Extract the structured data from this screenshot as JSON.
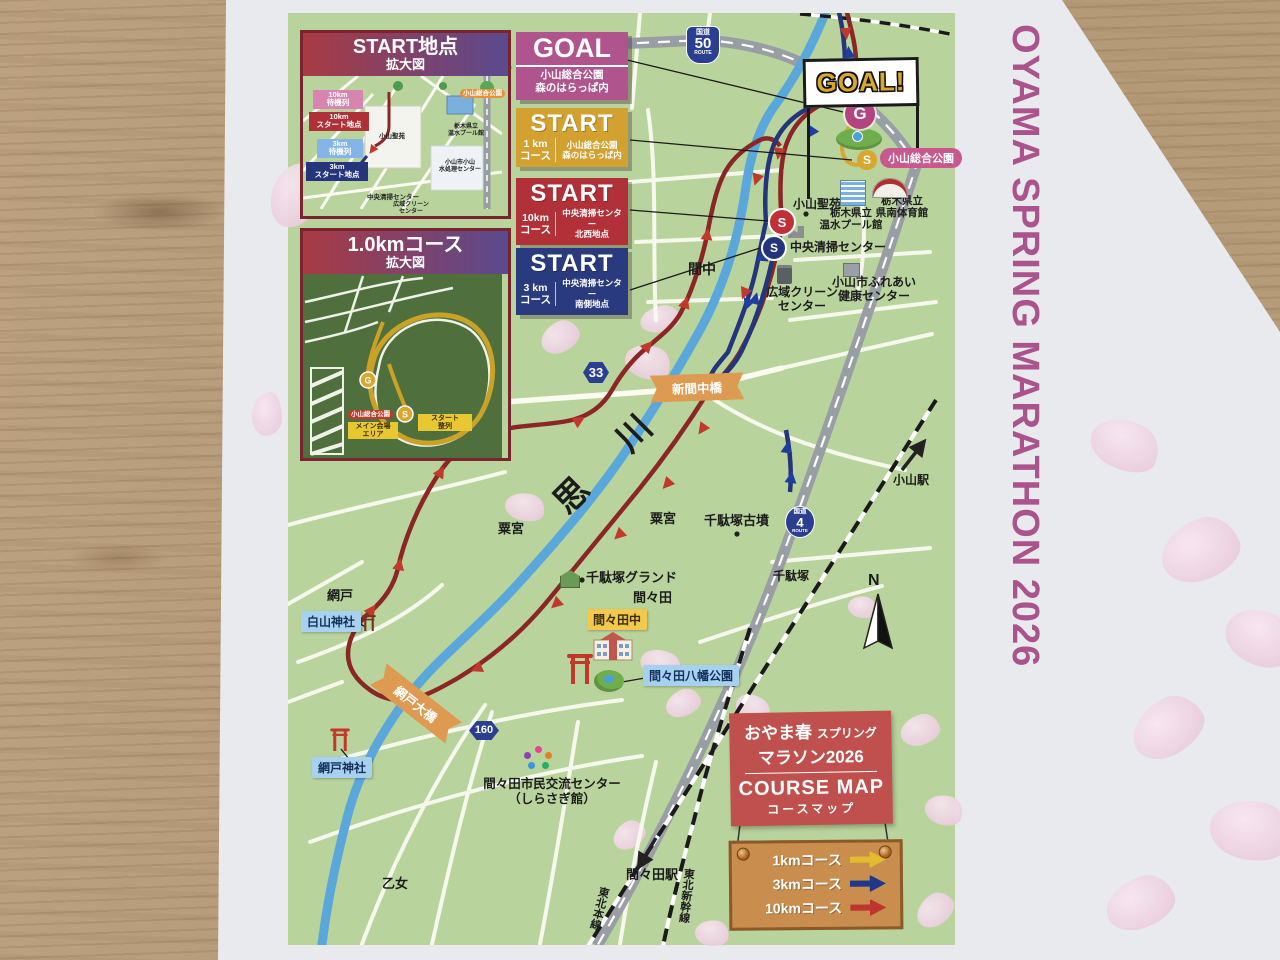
{
  "side_title": "OYAMA SPRING MARATHON 2026",
  "goal_banner": "GOAL!",
  "markers": {
    "g": "G",
    "s": "S",
    "n": "N"
  },
  "goal_box": {
    "title": "GOAL",
    "location": "小山総合公園\n森のはらっぱ内"
  },
  "start_boxes": [
    {
      "title": "START",
      "course": "1 km\nコース",
      "location": "小山総合公園\n森のはらっぱ内"
    },
    {
      "title": "START",
      "course": "10km\nコース",
      "location": "中央清掃センター\n北西地点"
    },
    {
      "title": "START",
      "course": "3 km\nコース",
      "location": "中央清掃センター\n南側地点"
    }
  ],
  "inset_start": {
    "title": "START地点",
    "subtitle": "拡大図",
    "tags": {
      "wait10": "10km\n待機列",
      "start10": "10km\nスタート地点",
      "wait3": "3km\n待機列",
      "start3": "3km\nスタート地点"
    },
    "places": {
      "seien": "小山聖苑",
      "pool": "栃木県立\n温水プール館",
      "mizushori": "小山市小山\n水処理センター",
      "seiso": "中央清掃センター",
      "clean": "広域クリーン\nセンター",
      "park": "小山総合公園"
    }
  },
  "inset_1km": {
    "title": "1.0kmコース",
    "subtitle": "拡大図",
    "park": "小山総合公園",
    "main_area": "メイン会場\nエリア",
    "start_grid": "スタート\n整列"
  },
  "badges": {
    "r50": {
      "kanji": "国道",
      "num": "50",
      "route": "ROUTE"
    },
    "r4": {
      "kanji": "国道",
      "num": "4",
      "route": "ROUTE"
    },
    "r33": "33",
    "r160": "160"
  },
  "map_labels": {
    "mamanaka": "間中",
    "omoigawa": "思　川",
    "awanomiya_w": "粟宮",
    "awanomiya_e": "粟宮",
    "sendazuka_kofun": "千駄塚古墳",
    "sendazuka": "千駄塚",
    "sendazuka_ground": "千駄塚グランド",
    "mamada": "間々田",
    "mamada_chu": "間々田中",
    "mamada_hachiman": "間々田八幡公園",
    "ajito": "網戸",
    "hakusan_jinja": "白山神社",
    "ajito_ohashi": "網戸大橋",
    "ajito_jinja": "網戸神社",
    "shimin_center": "間々田市民交流センター\n（しらさぎ館）",
    "otome": "乙女",
    "mamada_sta": "間々田駅",
    "tohoku_honsen": "東北本線",
    "tohoku_shinkansen": "東北新幹線",
    "oyama_sta": "小山駅",
    "shinmamanaka_bashi": "新間中橋",
    "oyama_seien": "小山聖苑",
    "onsui_pool": "栃木県立\n温水プール館",
    "kennan_gym": "栃木県立\n県南体育館",
    "chuo_seiso": "中央清掃センター",
    "koiki_clean": "広域クリーン\nセンター",
    "fureai": "小山市ふれあい\n健康センター",
    "sogo_koen": "小山総合公園"
  },
  "legend": {
    "title_ja_main": "おやま春",
    "title_ja_sub": "スプリング",
    "title_ja_line2": "マラソン2026",
    "title_en": "COURSE MAP",
    "title_en_sub": "コースマップ",
    "items": [
      {
        "label": "1kmコース",
        "color": "#e3bb2f"
      },
      {
        "label": "3kmコース",
        "color": "#20388c"
      },
      {
        "label": "10kmコース",
        "color": "#bf3430"
      }
    ]
  },
  "colors": {
    "map_green": "#b9d39c",
    "river_blue": "#5aa7dc",
    "course_10km": "#8b2626",
    "course_3km": "#24357c",
    "course_1km": "#d9a62e",
    "title_pink": "#aa538c"
  }
}
